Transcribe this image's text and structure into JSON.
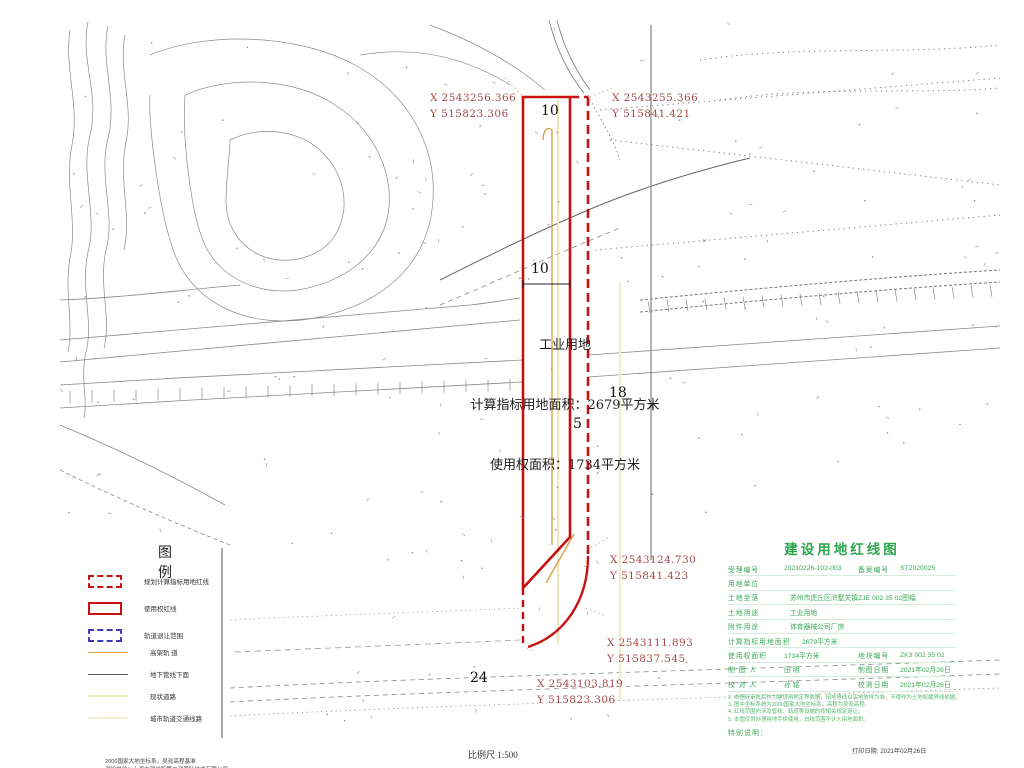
{
  "map": {
    "coords": [
      {
        "x": "X 2543256.366",
        "y": "Y 515823.306"
      },
      {
        "x": "X 2543255.366",
        "y": "Y 515841.421"
      },
      {
        "x": "X 2543124.730",
        "y": "Y 515841.423"
      },
      {
        "x": "X 2543111.893",
        "y": "Y 515837.545"
      },
      {
        "x": "X 2543103.819",
        "y": "Y 515823.306"
      }
    ],
    "parcel": {
      "land_use": "工业用地",
      "area_line1": "计算指标用地面积：2679平方米",
      "area_line2": "使用权面积：1734平方米"
    },
    "dims": {
      "top": "10",
      "mid": "10",
      "gap": "5",
      "right": "18",
      "bottom": "24"
    }
  },
  "legend": {
    "title": "图 例",
    "items": [
      {
        "label": "规划计算指标用地红线",
        "type": "red-dashed-rect"
      },
      {
        "label": "使用权红线",
        "type": "red-solid-rect"
      },
      {
        "label": "轨道退让范围",
        "type": "blue-dashed-rect"
      },
      {
        "label": "高架轨 道",
        "type": "orange-line"
      },
      {
        "label": "地下管线下面",
        "type": "gray-line"
      },
      {
        "label": "现状道路",
        "type": "pale-line"
      },
      {
        "label": "城市轨道交通线路",
        "type": "pale-line2"
      }
    ]
  },
  "title_block": {
    "title": "建设用地红线图",
    "rows": [
      {
        "cells": [
          "受理编号",
          "20210226-102-003",
          "备案编号",
          "ST2020025"
        ]
      },
      {
        "cells": [
          "用地单位",
          ""
        ]
      },
      {
        "cells": [
          "土地坐落",
          "苏州市虎丘区浒墅关镇ZJE 002 35 02图幅"
        ]
      },
      {
        "cells": [
          "土地用途",
          "工业用地"
        ]
      },
      {
        "cells": [
          "附件用途",
          "体育器械公司厂房"
        ]
      },
      {
        "cells": [
          "计算指标用地面积",
          "2679平方米"
        ]
      },
      {
        "cells": [
          "使用权面积",
          "1734平方米",
          "地块编号",
          "ZK3 002 35 02"
        ]
      },
      {
        "cells": [
          "制 图 人",
          "田  明",
          "制图日期",
          "2021年02月26日"
        ]
      },
      {
        "cells": [
          "校 对 人",
          "孙  铭",
          "校测日期",
          "2021年02月26日"
        ]
      }
    ],
    "notes": [
      "2. 本图经审批后作为建设用地定界依据，用地界线以实地放样为准，不得作为土地权属界线依据。",
      "3. 图中坐标系统为2000国家大地坐标系，高程为吴淞高程。",
      "4. 红线范围内涉及管线、轨道等设施的按相关规定退让。",
      "5. 本图仅供办理用地手续使用，白线范围不计入用地面积。"
    ],
    "special_note": "特别说明："
  },
  "footer": {
    "scale_label": "比例尺 1:500",
    "datum_line1": "2000国家大地坐标系，吴淞高程基准",
    "datum_line2": "测绘单位：上海市测绘院第二测量队技术有限公司",
    "print_date": "打印日期: 2021年02月26日"
  }
}
